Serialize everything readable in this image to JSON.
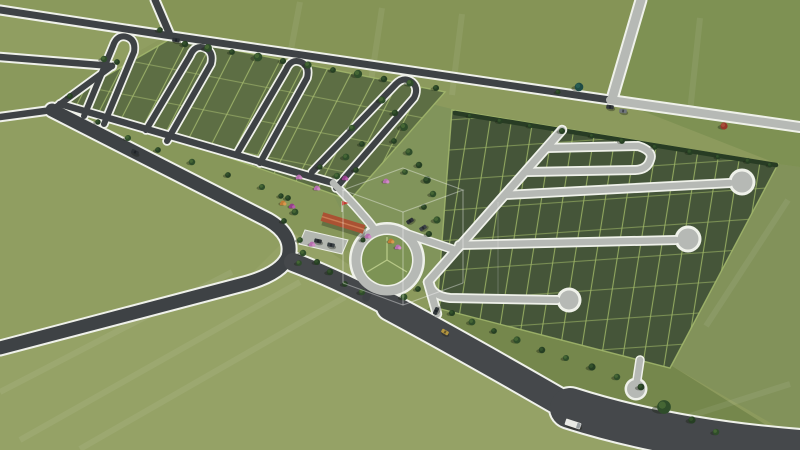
{
  "meta": {
    "title": "Aerial 3D render of a residential land subdivision master plan",
    "description": "Bird's-eye architectural visualization of plotted green land parcels: a west block with dark asphalt hairpin loop streets, an east block with light concrete lollipop cul-de-sac streets, a central landscaped amenity area with roundabout and terracotta-roof clubhouse, perimeter roads, a wide highway with vehicles, tree rows and a faint wireframe-cube watermark in the center"
  },
  "palette": {
    "field_base": "#8c9a5d",
    "field_light": "#95a266",
    "field_mid": "#909e61",
    "field_topleft": "#8a995c",
    "field_topmid": "#859456",
    "field_topright": "#7e9153",
    "field_east": "#82925a",
    "field_strip": "#87975a",
    "tree_strip": "#75874c",
    "amenity": "#81945b",
    "parcel_left": "#5d6e44",
    "parcel_right": "#455539",
    "lot_line": "#a3b86d",
    "lot_line_bright": "#9db566",
    "road_dark": "#3e4245",
    "road_light": "#b6b9b5",
    "road_white": "#eff1ea",
    "highway": "#45484b",
    "hedge": "#283c24",
    "grass_island": "#7d9355",
    "spoke": "#b7c887",
    "roof": "#aa5233",
    "roof_ridge": "#c97a52",
    "flag_red": "#c03a2e",
    "watermark": "rgba(255,255,255,0.38)"
  },
  "vehicles": [
    {
      "type": "car",
      "x": 176,
      "y": 40,
      "angle": 8,
      "color": "#2d3236",
      "label": "car-north-boundary-road"
    },
    {
      "type": "car",
      "x": 610,
      "y": 107,
      "angle": 8,
      "color": "#33383b",
      "label": "car-east-boundary-road"
    },
    {
      "type": "car",
      "x": 623,
      "y": 111,
      "angle": 8,
      "color": "#70767a",
      "label": "car-east-boundary-road-2"
    },
    {
      "type": "car",
      "x": 410,
      "y": 221,
      "angle": -32,
      "color": "#2d3236",
      "label": "car-roundabout-link"
    },
    {
      "type": "car",
      "x": 423,
      "y": 228,
      "angle": -32,
      "color": "#3c4246",
      "label": "car-roundabout-link-2"
    },
    {
      "type": "car",
      "x": 436,
      "y": 311,
      "angle": -65,
      "color": "#2f3539",
      "label": "car-block-entrance"
    },
    {
      "type": "car",
      "x": 445,
      "y": 332,
      "angle": 30,
      "color": "#b3953f",
      "label": "yellow-car-on-highway"
    },
    {
      "type": "car",
      "x": 135,
      "y": 152,
      "angle": 27,
      "color": "#2d3236",
      "label": "car-on-boulevard"
    },
    {
      "type": "car",
      "x": 318,
      "y": 241,
      "angle": 12,
      "color": "#2c3134",
      "label": "parked-car-clubhouse"
    },
    {
      "type": "car",
      "x": 331,
      "y": 245,
      "angle": 12,
      "color": "#3a4144",
      "label": "parked-car-clubhouse-2"
    },
    {
      "type": "truck",
      "x": 573,
      "y": 424,
      "angle": 18,
      "color": "#e8e9e5",
      "label": "white-truck-on-highway"
    }
  ],
  "watermark": {
    "shape": "wireframe-cube"
  }
}
